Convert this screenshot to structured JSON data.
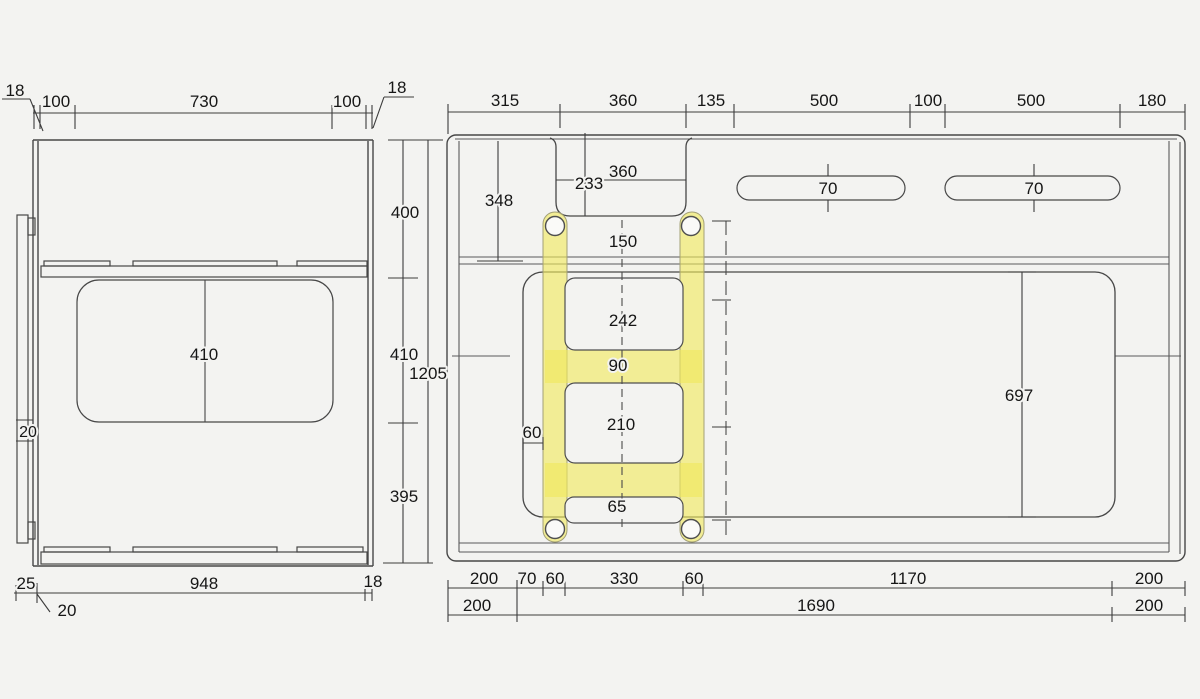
{
  "drawing": {
    "type": "technical-dimension-drawing",
    "highlighted_part": "h-bracket",
    "colors": {
      "background": "#f3f3f1",
      "line": "#474747",
      "dim_line": "#3c3c3c",
      "highlight_yellow": "#f0e95c",
      "text": "#161616"
    },
    "left_view": {
      "top_chain": [
        "18",
        "100",
        "730",
        "100",
        "18"
      ],
      "right_chain": [
        "400",
        "410",
        "395"
      ],
      "overall_height": "1205",
      "panel_center_dim": "410",
      "strip_dim": "20",
      "bottom_chain": [
        "25",
        "948",
        "18"
      ],
      "bottom_leader": "20"
    },
    "right_view": {
      "top_chain": [
        "315",
        "360",
        "135",
        "500",
        "100",
        "500",
        "180"
      ],
      "notch_dims": [
        "233",
        "360"
      ],
      "left_vertical": "348",
      "slot_heights": [
        "70",
        "70"
      ],
      "bracket_dims": [
        "150",
        "242",
        "90",
        "210",
        "60",
        "65"
      ],
      "cutout_height": "697",
      "bottom_chain_1": [
        "200",
        "70",
        "60",
        "330",
        "60",
        "1170",
        "200"
      ],
      "bottom_chain_2": [
        "200",
        "1690",
        "200"
      ]
    }
  },
  "dims": {
    "lv_18_tl": "18",
    "lv_100_l": "100",
    "lv_730": "730",
    "lv_100_r": "100",
    "lv_18_tr": "18",
    "lv_410_panel": "410",
    "lv_20_strip": "20",
    "lv_400": "400",
    "lv_410_chain": "410",
    "lv_1205": "1205",
    "lv_395": "395",
    "lv_25": "25",
    "lv_948": "948",
    "lv_18_br": "18",
    "lv_20_b": "20",
    "rv_315": "315",
    "rv_360_top": "360",
    "rv_135": "135",
    "rv_500_a": "500",
    "rv_100": "100",
    "rv_500_b": "500",
    "rv_180": "180",
    "rv_233": "233",
    "rv_360_in": "360",
    "rv_348": "348",
    "rv_70_a": "70",
    "rv_70_b": "70",
    "rv_150": "150",
    "rv_242": "242",
    "rv_90": "90",
    "rv_210": "210",
    "rv_60_win": "60",
    "rv_65": "65",
    "rv_697": "697",
    "rb_200_a": "200",
    "rb_70": "70",
    "rb_60_a": "60",
    "rb_330": "330",
    "rb_60_b": "60",
    "rb_1170": "1170",
    "rb_200_b": "200",
    "rb2_200_a": "200",
    "rb2_1690": "1690",
    "rb2_200_b": "200"
  }
}
